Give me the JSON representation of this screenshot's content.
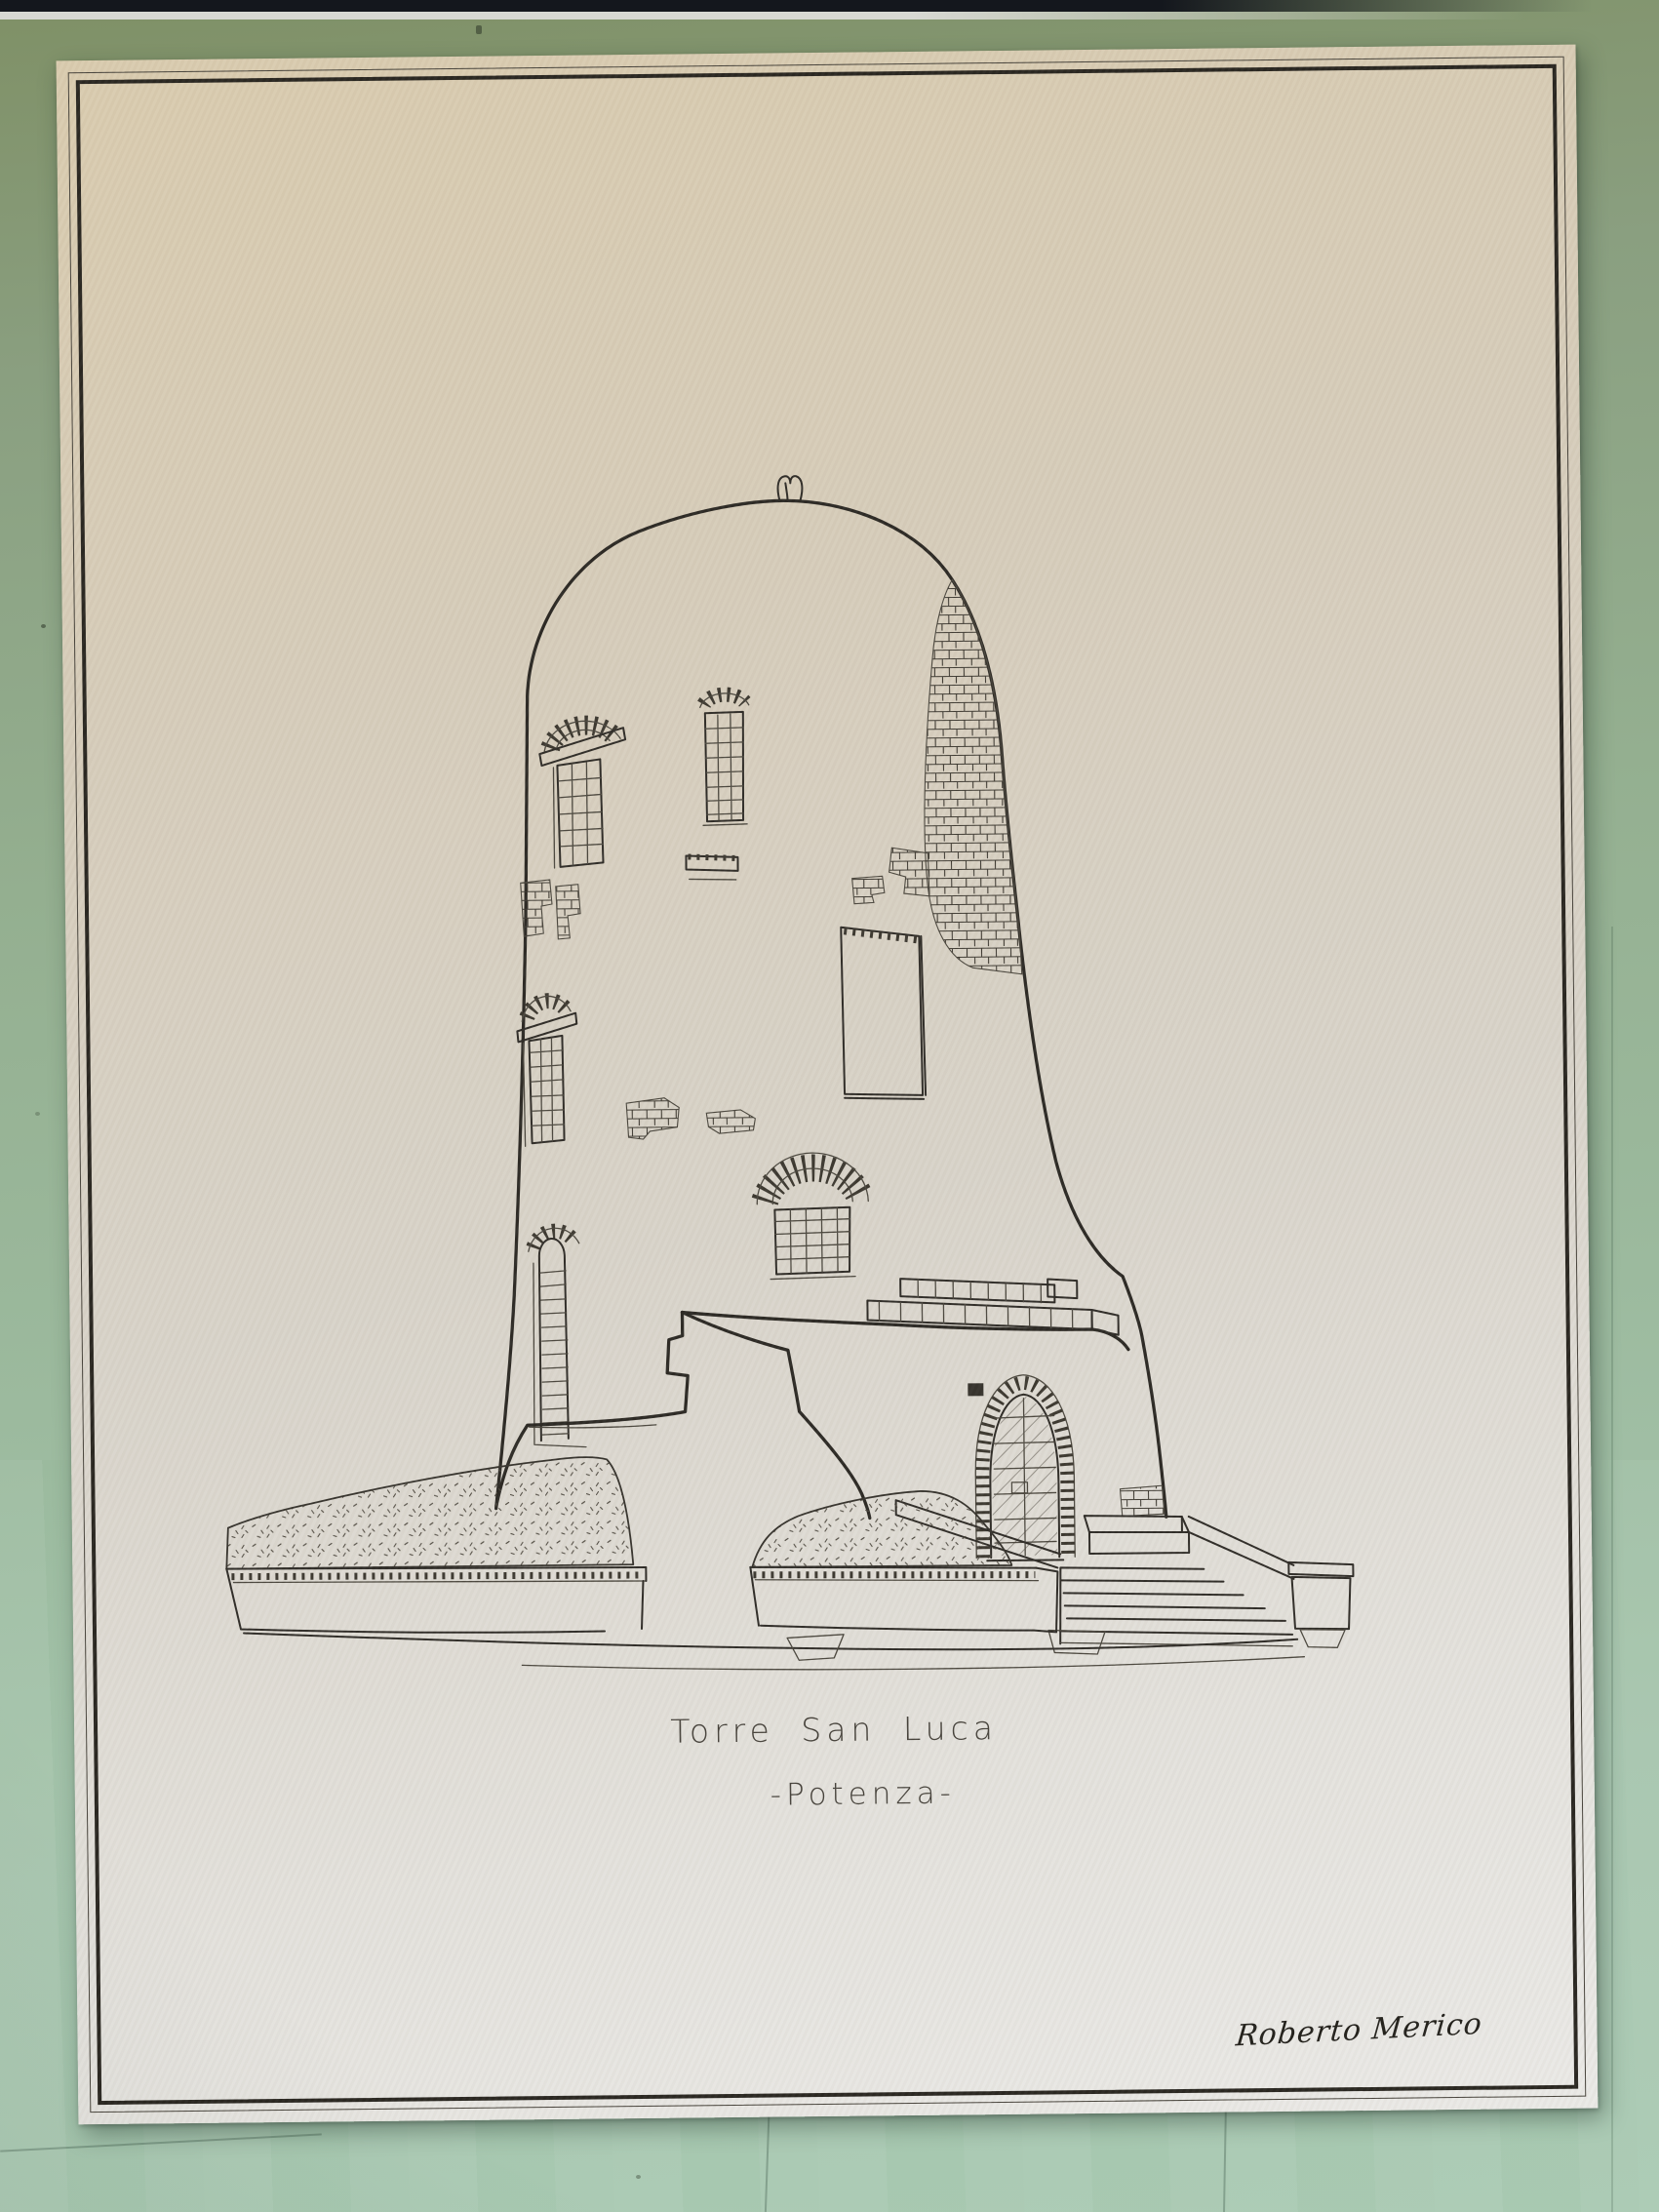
{
  "scene": {
    "type": "photograph of a hand-drawn architectural poster on a green backing board",
    "board_color_top": "#7f9066",
    "board_color_bottom": "#aacab3",
    "shelf_band_color": "#14171d",
    "shelf_strip_color": "#d8d9d3"
  },
  "poster": {
    "paper_color": "#d7cdb9",
    "ink_color": "#2e2b26",
    "border": "double rule, thin outer line and thick inner line",
    "title": "Torre San Luca",
    "subtitle": "-Potenza-",
    "signature": "Roberto Merico",
    "artwork": {
      "subject": "round-stone-tower",
      "features": [
        "domed top with small finial",
        "exposed-brick patches",
        "barred arched windows",
        "arched doorway with brick voussoirs",
        "stone staircase with sloped railing",
        "hedge planters",
        "ruined wall at base"
      ]
    }
  }
}
